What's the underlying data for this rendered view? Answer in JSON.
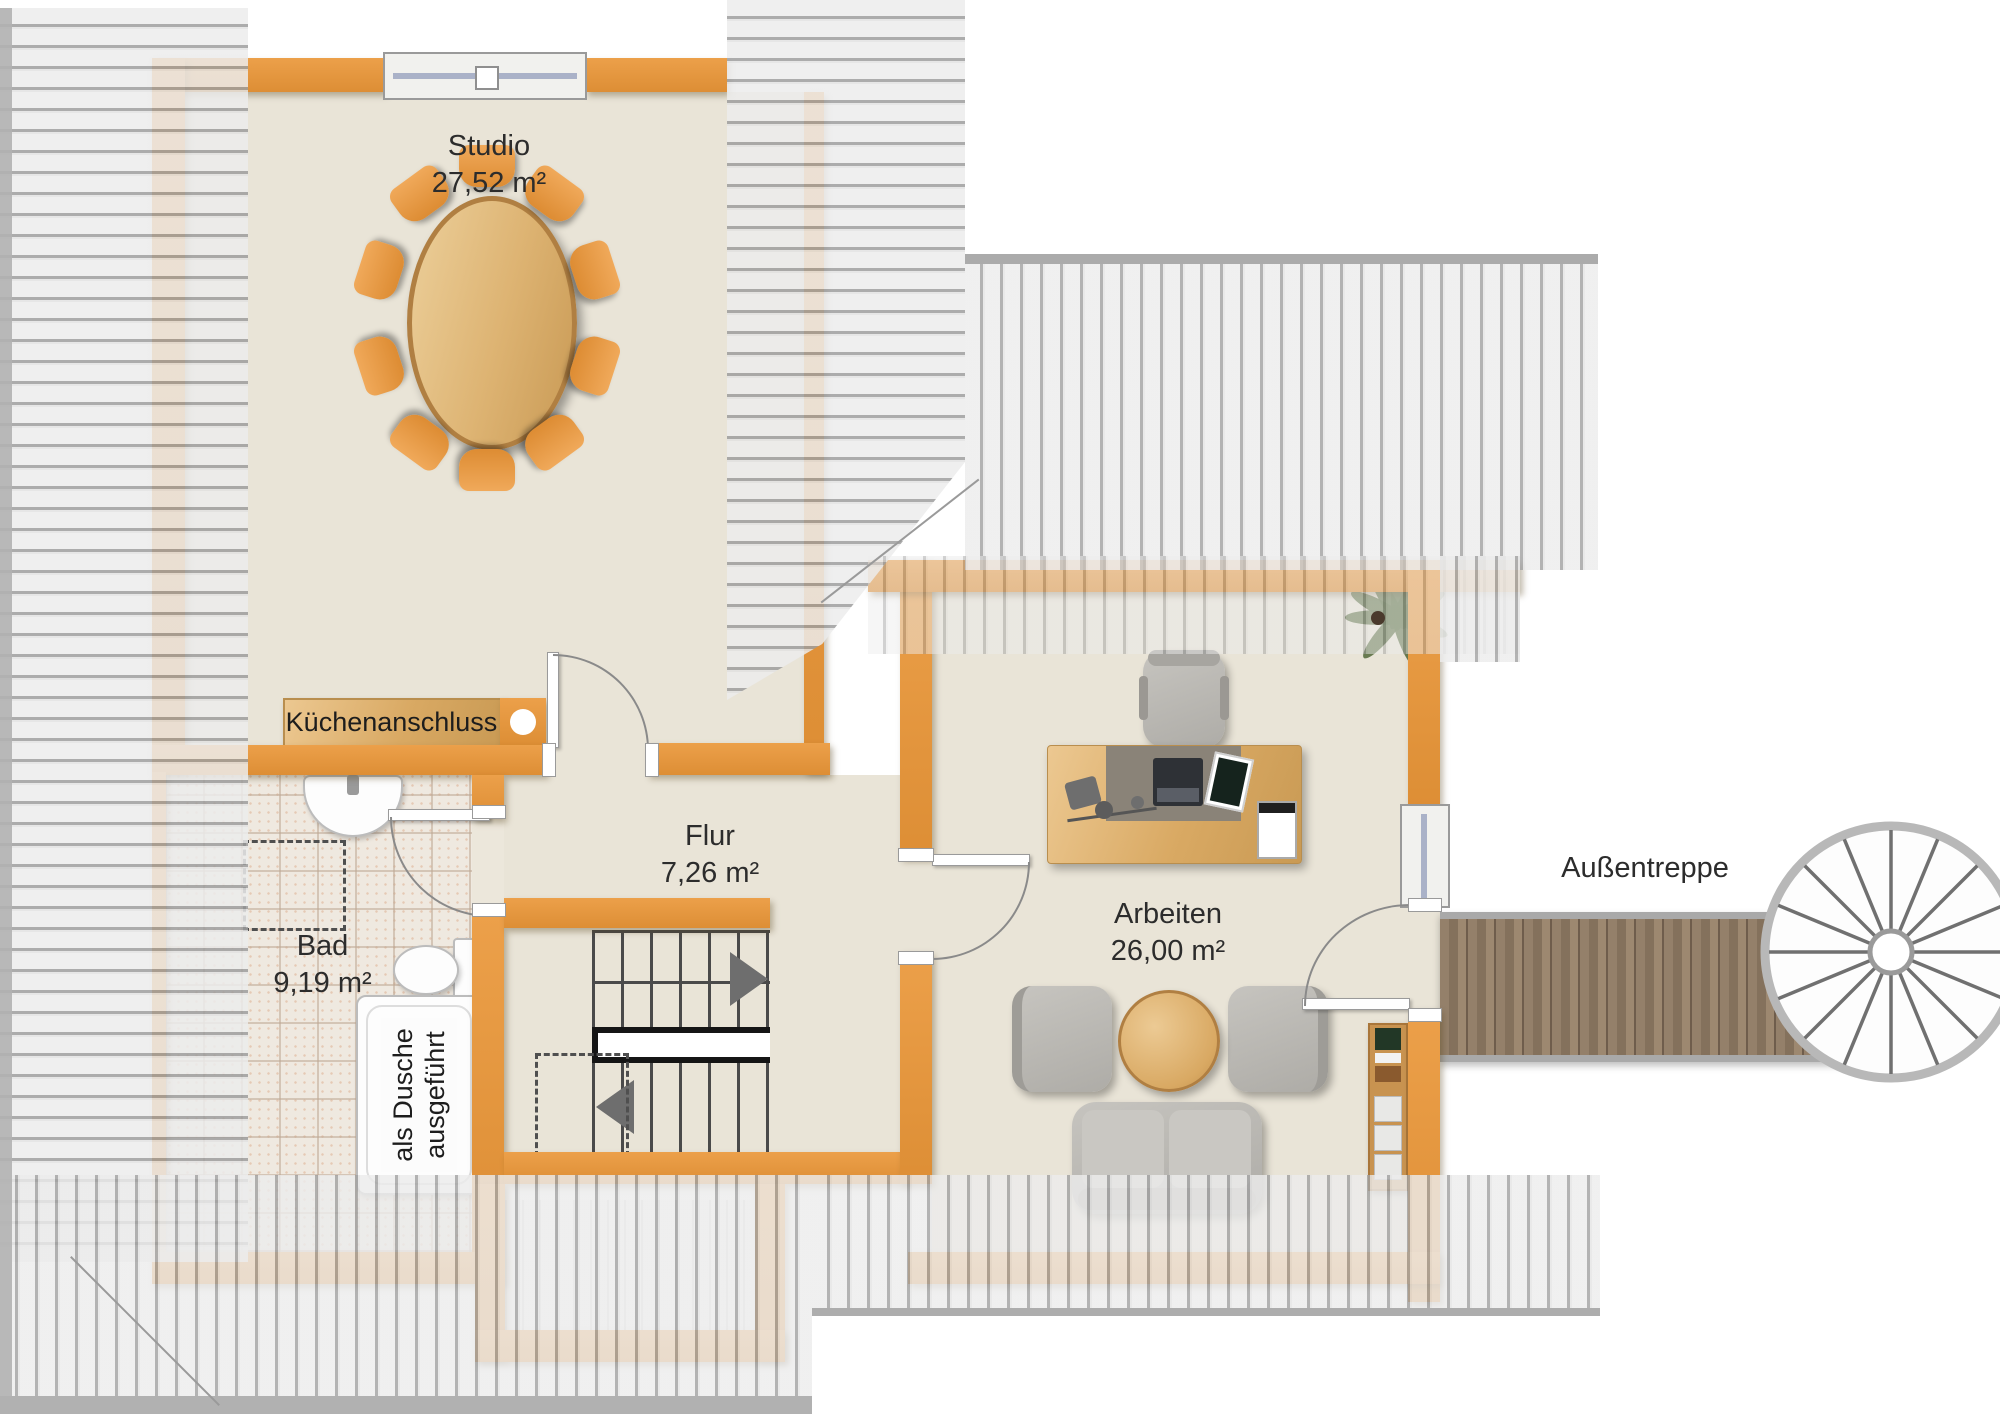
{
  "plan": {
    "rooms": [
      {
        "id": "studio",
        "name": "Studio",
        "area": "27,52 m²"
      },
      {
        "id": "flur",
        "name": "Flur",
        "area": "7,26 m²"
      },
      {
        "id": "bad",
        "name": "Bad",
        "area": "9,19 m²"
      },
      {
        "id": "arbeiten",
        "name": "Arbeiten",
        "area": "26,00 m²"
      }
    ],
    "annotations": {
      "kitchen_connection": "Küchenanschluss",
      "outdoor_staircase": "Außentreppe",
      "shower_note": [
        "als Dusche",
        "ausgeführt"
      ]
    },
    "colors": {
      "wall": "#e2953f",
      "floor": "#e9e4d7",
      "roof_hatch": "#d9d9d9",
      "wood": "#dcae6b",
      "deck": "#8a7561",
      "upholstery": "#b9b7b2"
    }
  }
}
